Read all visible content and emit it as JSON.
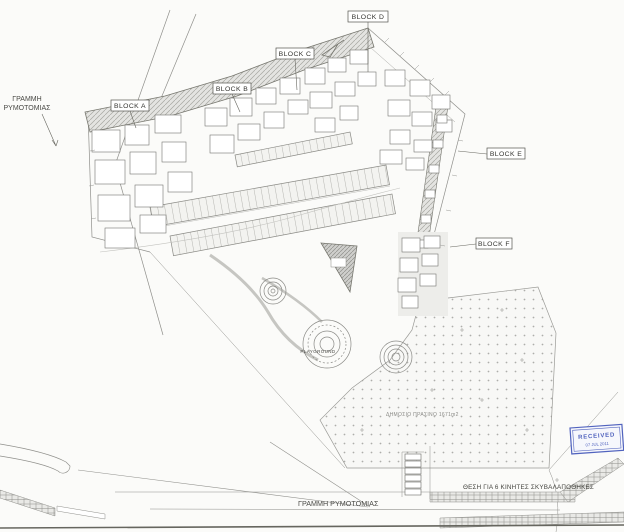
{
  "plan": {
    "blocks": [
      {
        "label": "BLOCK A"
      },
      {
        "label": "BLOCK B"
      },
      {
        "label": "BLOCK C"
      },
      {
        "label": "BLOCK D"
      },
      {
        "label": "BLOCK E"
      },
      {
        "label": "BLOCK F"
      }
    ],
    "annotations": {
      "street_line_top_1": "ΓΡΑΜΜΗ",
      "street_line_top_2": "ΡΥΜΟΤΟΜΙΑΣ",
      "street_line_bottom": "ΓΡΑΜΜΗ ΡΥΜΟΤΟΜΙΑΣ",
      "garbage_note": "ΘΕΣΗ ΓΙΑ 6 ΚΙΝΗΤΕΣ ΣΚΥΒΑΛΑΠΟΘΗΚΕΣ",
      "public_green": "ΔΗΜΟΣΙΟ ΠΡΑΣΙΝΟ 1671m2",
      "playground": "PLAYGROUND"
    },
    "stamp": {
      "line1": "RECEIVED",
      "line2": "07 JUL 2011"
    },
    "colors": {
      "ink": "#55554f",
      "stamp_blue": "#5163be",
      "paper": "#fbfbf9"
    }
  }
}
